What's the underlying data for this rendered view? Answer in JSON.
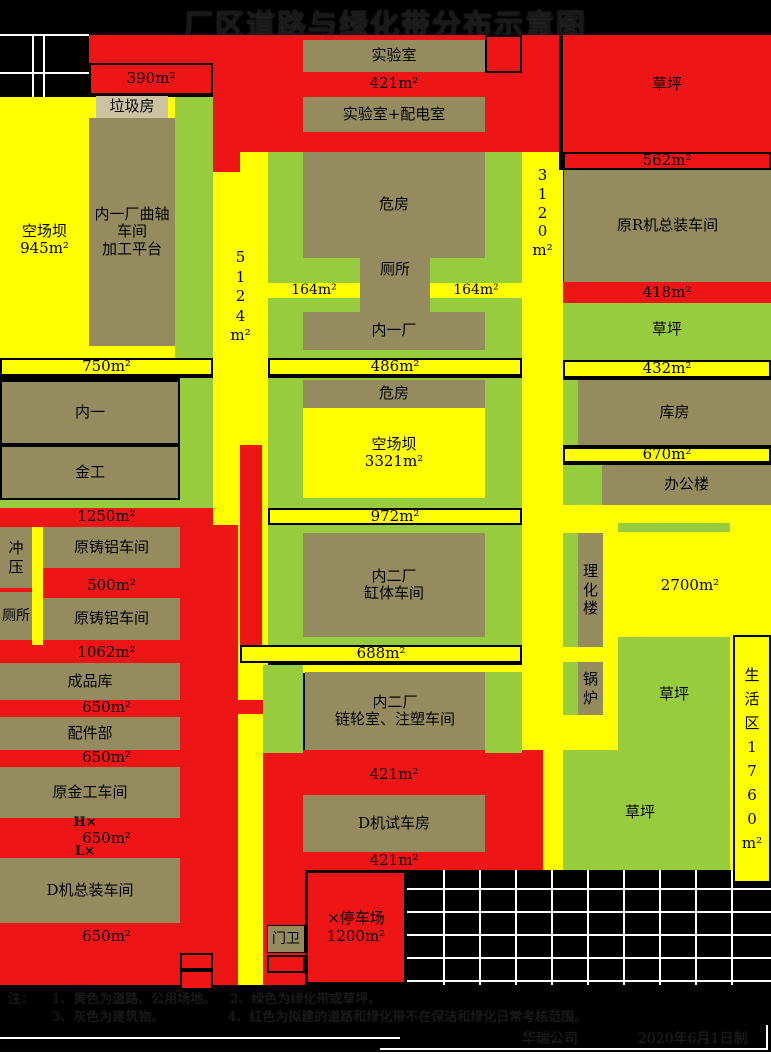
{
  "title": "厂区道路与绿化带分布示意图",
  "colors": {
    "road_yellow": "#FFFF00",
    "lawn_green": "#97CC3F",
    "planned_red": "#ED1515",
    "building_olive": "#948C5F",
    "building_light_tan": "#CCC3A3",
    "background": "#000000",
    "grid_line": "#FFFFFF"
  },
  "blocks": {
    "laji": "垃圾房",
    "quzhou": "内一厂曲轴\n车间\n加工平台",
    "kongchangba1": "空场坝\n945m²",
    "shiyanshi": "实验室",
    "shiyan_peidian": "实验室+配电室",
    "weifang": "危房",
    "cesuo": "厕所",
    "neiyichang": "内一厂",
    "caoping": "草坪",
    "yuanRji": "原R机总装车间",
    "neiyi": "内一",
    "jingong": "金工",
    "chongya": "冲\n压",
    "yuanzhulv": "原铸铝车间",
    "chengpinku": "成品库",
    "peijianbu": "配件部",
    "yuanjingong": "原金工车间",
    "djizongzhuang": "D机总装车间",
    "kongchangba2": "空场坝\n3321m²",
    "neier_gangti": "内二厂\n缸体车间",
    "kufang": "库房",
    "bangonglou": "办公楼",
    "lihualou": "理\n化\n楼",
    "guolu": "锅\n炉",
    "neier_lianlun": "内二厂\n链轮室、注塑车间",
    "djishiche": "D机试车房",
    "menwei": "门卫",
    "tingche": "×停车场\n1200m²",
    "shenghuo": "生\n活\n区\n1\n7\n6\n0\nm²"
  },
  "areas": {
    "a390": "390m²",
    "a421": "421m²",
    "a562": "562m²",
    "a418": "418m²",
    "a3120": "3\n1\n2\n0\nm²",
    "a5124": "5\n1\n2\n4\nm²",
    "a164": "164m²",
    "a750": "750m²",
    "a486": "486m²",
    "a432": "432m²",
    "a670": "670m²",
    "a1250": "1250m²",
    "a500": "500m²",
    "a1062": "1062m²",
    "a972": "972m²",
    "a2700": "2700m²",
    "a688": "688m²",
    "a650": "650m²",
    "hx": "H×",
    "lx": "L×"
  },
  "notes": {
    "prefix": "注：",
    "item1": "1、黄色为道路、公用场地。",
    "item2": "2、绿色为绿化带或草坪。",
    "item3": "3、灰色为建筑物。",
    "item4": "4、红色为拟建的道路和绿化带不在保洁和绿化日常考核范围。",
    "company": "华瑞公司",
    "date": "2020年6月1日制"
  }
}
